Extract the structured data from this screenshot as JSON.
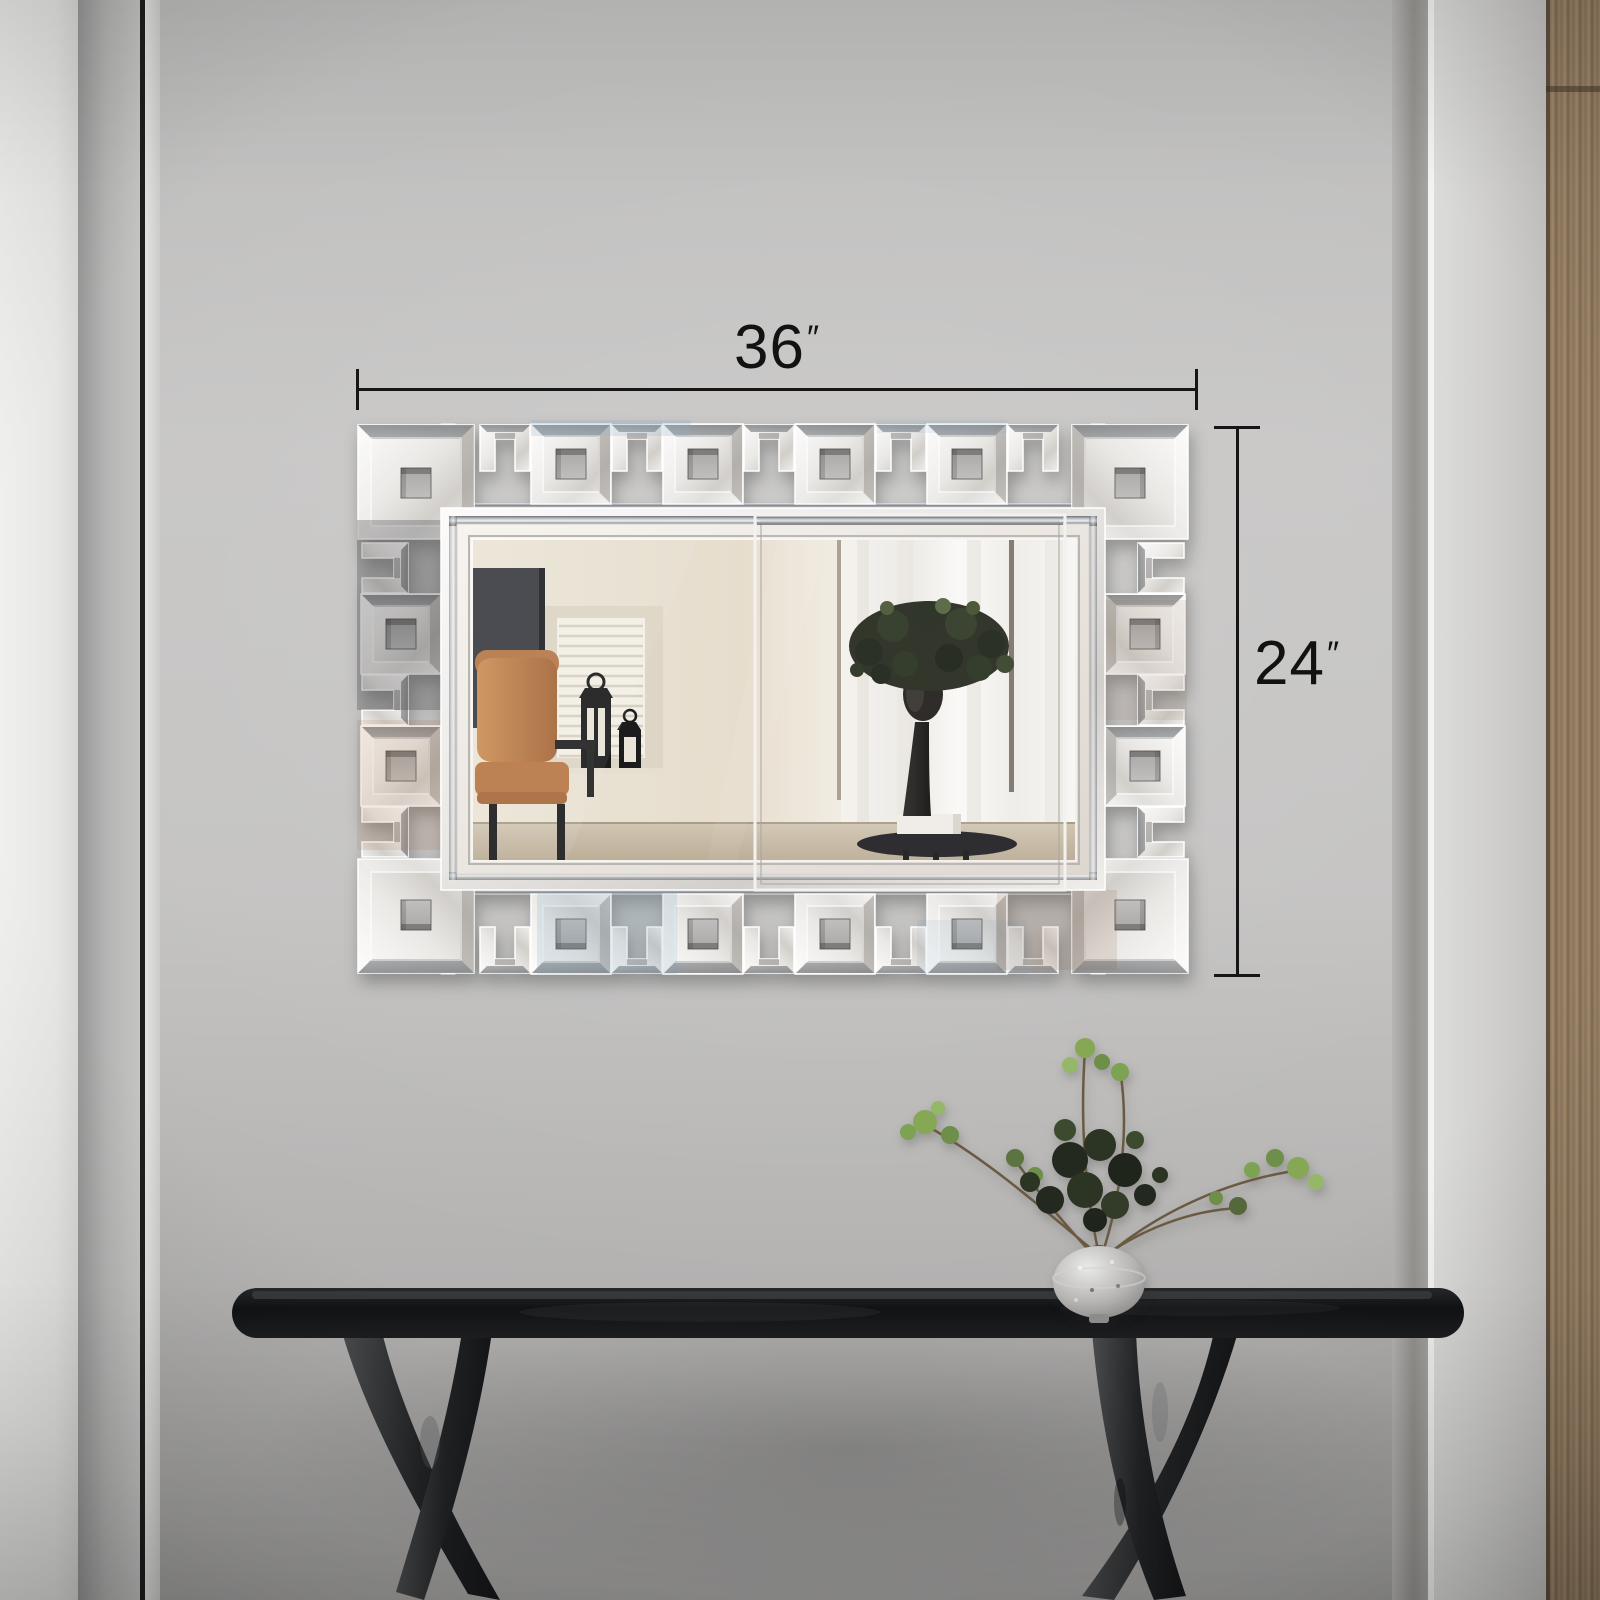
{
  "annotations": {
    "width": {
      "value": "36",
      "prime": "″"
    },
    "height": {
      "value": "24",
      "prime": "″"
    }
  },
  "palette": {
    "wall": "#c4c3c2",
    "dimension_line": "#161616",
    "mirror_face": "#ece9e5",
    "wood_trim": "#937d63",
    "console_table": "#1b1c1e",
    "leather_chair": "#b97a49",
    "foliage_green": "#7ea24f",
    "sculpture": "#242220"
  }
}
